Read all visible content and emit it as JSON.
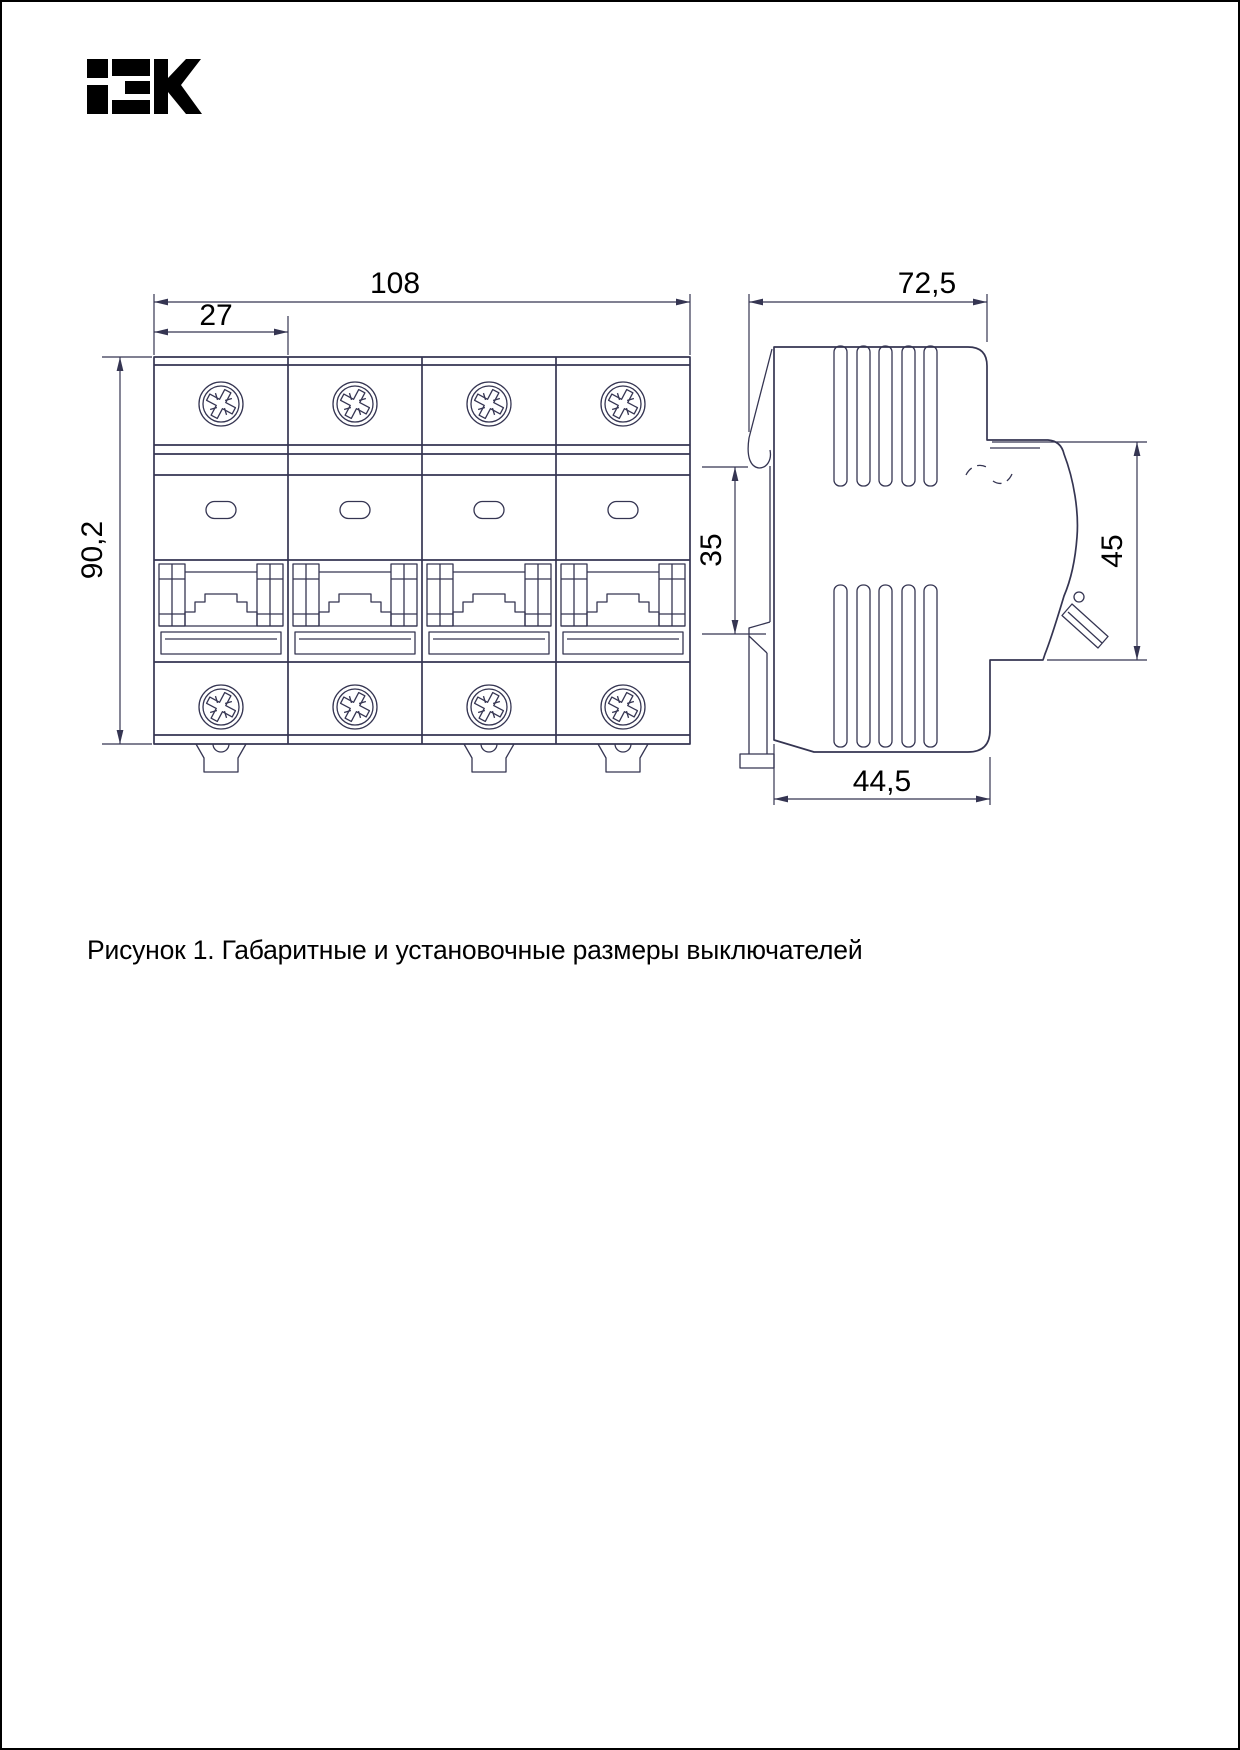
{
  "brand": {
    "logo_text": "IEK"
  },
  "caption": "Рисунок 1. Габаритные и установочные размеры выключателей",
  "figure": {
    "front_view": {
      "label": "front-view-4-pole-breaker",
      "dim_width": "108",
      "dim_module": "27",
      "dim_height": "90,2",
      "modules": 4,
      "screws_per_module": 2
    },
    "side_view": {
      "label": "side-view-breaker-profile",
      "dim_depth": "72,5",
      "dim_rail": "35",
      "dim_front": "45",
      "dim_base": "44,5"
    }
  },
  "colors": {
    "line": "#353552",
    "text": "#000000",
    "background": "#ffffff"
  }
}
